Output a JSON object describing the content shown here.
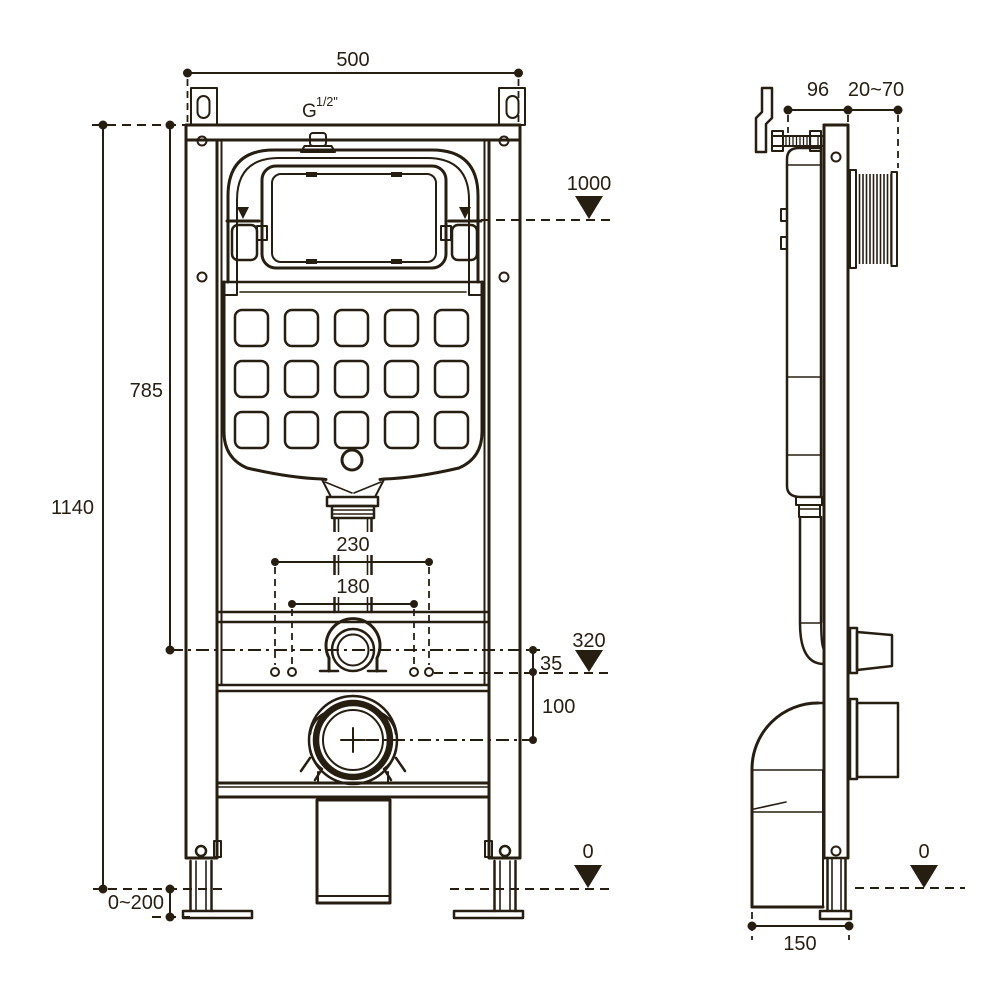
{
  "drawing_type": "installation dimensions diagram, concealed WC cistern frame",
  "colors": {
    "line": "#271e12",
    "background": "#ffffff"
  },
  "views": {
    "front": {
      "name": "front view",
      "labels": {
        "overall_width": "500",
        "thread_g": "G",
        "thread_size": "1/2\"",
        "level_top": "1000",
        "upper_height": "785",
        "overall_height": "1140",
        "flush_pipe_spacing_outer": "230",
        "flush_pipe_spacing_inner": "180",
        "level_inlet": "320",
        "inlet_offset": "35",
        "outlet_drop": "100",
        "foot_adjustment": "0~200",
        "level_floor": "0"
      }
    },
    "side": {
      "name": "side view",
      "labels": {
        "frame_depth": "96",
        "wall_distance": "20~70",
        "outlet_depth": "150",
        "level_floor": "0"
      }
    }
  }
}
